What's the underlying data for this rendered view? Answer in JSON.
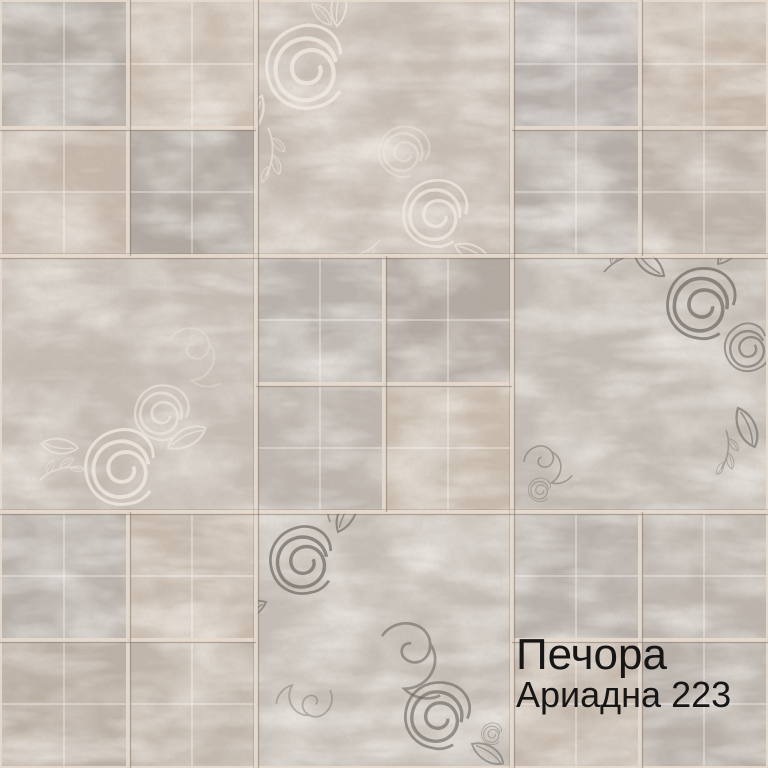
{
  "label": {
    "line1": "Печора",
    "line2": "Ариадна 223",
    "text_color": "#161616"
  },
  "palette": {
    "background": "#d8ccc0",
    "grout_light": "#e7dbcf",
    "grout_shadow": "#96897b",
    "score_line": "#ffffff",
    "floral_white": "#f1eae1",
    "floral_gray": "#6e6964"
  },
  "tiles": {
    "cellA": [
      "#b2aaa3",
      "#cdc0b3",
      "#c6b8ab",
      "#b0a8a1"
    ],
    "cellC": [
      "#b6afab",
      "#c7b9ab",
      "#b4aca6",
      "#bfb4aa"
    ],
    "cellE": [
      "#b9b2ac",
      "#b3aaa2",
      "#bfb7b0",
      "#c9bcae"
    ],
    "cellG": [
      "#b7b0aa",
      "#c8bbae",
      "#bdb1a5",
      "#c3b8ac"
    ],
    "cellI": [
      "#b9b2ac",
      "#bdb5ae",
      "#c6b9ac",
      "#b8b0a9"
    ],
    "decorB": "#c9beb4",
    "decorD": "#c6bdb4",
    "decorF": "#c3bcb4",
    "decorH": "#c5beb6"
  }
}
